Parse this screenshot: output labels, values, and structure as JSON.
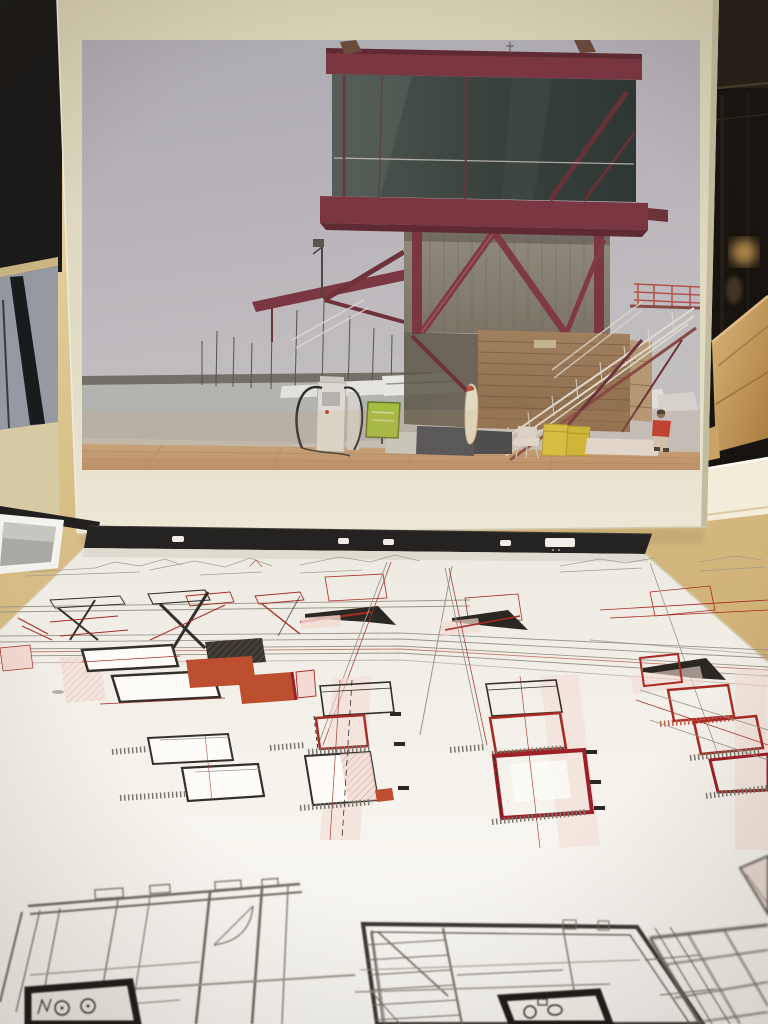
{
  "scene": {
    "description": "Photograph of an architecture exhibition table: a cream-mounted photo print of a red steel harbour control tower standing behind a large sheet of architectural plan drawings in black and red ink",
    "photo_board": {
      "label": "Cream mount board with photographic print of the building"
    },
    "building_photo": {
      "label": "Harbour watch tower: glass observation box on red steel frame over corrugated-metal and timber base, external white staircase, marina with sailboat masts, yachts, fuel pump, green sign, yellow bins and a person in a red shirt on a timber deck"
    },
    "display_case": {
      "label": "Dark display case with spot-lit wooden architectural model on the right"
    },
    "left_wall": {
      "label": "Black exhibition panel and gray floor glimpsed on the left"
    },
    "small_card": {
      "label": "Small white-bordered photo print lying at bottom left"
    },
    "drawing_sheet": {
      "label": "Large white sheet of phased plan, section and roof drawings in black, red and pink ink, black binding strip with punched holes at its far edge",
      "hole_marks": 5,
      "rows": [
        "faint elevation sketches at far edge",
        "stair section diagrams and black roof-wedge plans",
        "elevation strips with hatched and orange-filled volumes",
        "four descending columns of square floor plans with red outlines and pink hatching",
        "three large blurred foreground floor plans with thick black wet-room walls"
      ]
    }
  },
  "palette": {
    "table": "#d8c089",
    "table-dark": "#c6a86e",
    "board": "#ddd7bc",
    "board-edge": "#c2bc9e",
    "wall-black": "#1b1a19",
    "case-dark": "#17130f",
    "wood": "#c79b5f",
    "wood-light": "#e3bd85",
    "shelf": "#f3ecd8",
    "floor-gray": "#959aa2",
    "floor-beige": "#d6c9a4",
    "card-white": "#f4f2ec",
    "paper-top": "#edeae2",
    "paper-bottom": "#fbfaf6",
    "strip": "#252321",
    "ink": "#33302b",
    "ink-gray": "#9b968c",
    "ink-red": "#a82b24",
    "ink-crimson": "#9e1f28",
    "ink-orange": "#bc4f30",
    "ink-pink": "#f2d9d2",
    "steel-red": "#7c3440",
    "steel-dark": "#5f2731",
    "glass-dark": "#2c3531",
    "metal": "#8b8578",
    "wood-base": "#9c7a58",
    "deck": "#c59d74",
    "sea": "#b7b9b4",
    "white-rail": "#e6e1d6",
    "bin-yellow": "#dfc93a",
    "sign-green": "#a6c23e",
    "shirt-red": "#c23227"
  }
}
